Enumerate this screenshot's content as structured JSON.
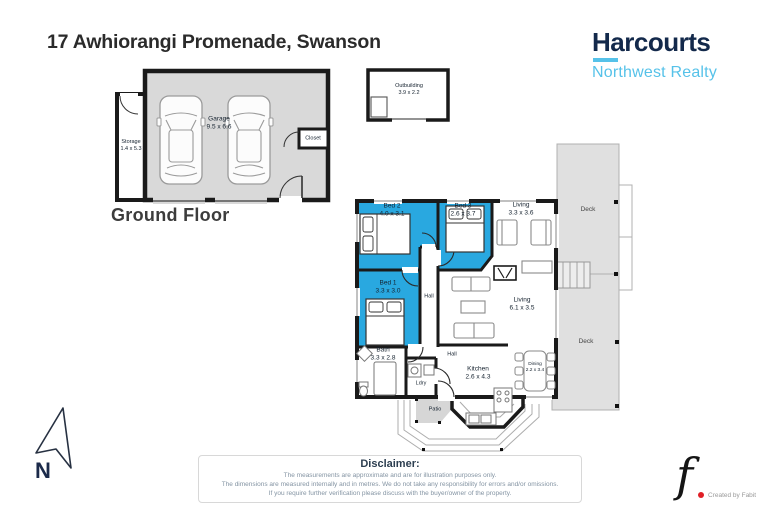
{
  "header": {
    "title": "17 Awhiorangi Promenade, Swanson",
    "brand": {
      "name": "Harcourts",
      "subtitle": "Northwest Realty"
    }
  },
  "ground_floor": {
    "caption": "Ground Floor",
    "rooms": [
      {
        "name": "Garage",
        "dims": "9.5 x 6.6"
      },
      {
        "name": "Storage",
        "dims": "1.4 x 5.3"
      },
      {
        "name": "Closet",
        "dims": ""
      }
    ]
  },
  "outbuilding": {
    "name": "Outbuilding",
    "dims": "3.9 x 2.2"
  },
  "main_floor": {
    "rooms": [
      {
        "name": "Bed 2",
        "dims": "4.0 x 3.1"
      },
      {
        "name": "Bed 3",
        "dims": "2.6 x 3.7"
      },
      {
        "name": "Living",
        "dims": "3.3 x 3.6"
      },
      {
        "name": "Bed 1",
        "dims": "3.3 x 3.0"
      },
      {
        "name": "Hall",
        "dims": ""
      },
      {
        "name": "Living",
        "dims": "6.1 x 3.5"
      },
      {
        "name": "Bath",
        "dims": "3.3 x 2.8"
      },
      {
        "name": "Hall",
        "dims": ""
      },
      {
        "name": "Ldry",
        "dims": ""
      },
      {
        "name": "Kitchen",
        "dims": "2.6 x 4.3"
      },
      {
        "name": "Dining",
        "dims": "2.2 x 3.4"
      },
      {
        "name": "Deck",
        "dims": ""
      },
      {
        "name": "Deck",
        "dims": ""
      },
      {
        "name": "Patio",
        "dims": ""
      }
    ]
  },
  "compass": {
    "label": "N"
  },
  "disclaimer": {
    "title": "Disclaimer:",
    "lines": [
      "The measurements are approximate and are for illustration purposes only.",
      "The dimensions are measured internally and in metres. We do not take any responsibility for errors and/or omissions.",
      "If you require further verification please discuss with the buyer/owner of the property."
    ]
  },
  "credit": {
    "monogram": "f",
    "text": "Created by Fabit"
  },
  "colors": {
    "bedroom_blue": "#29a8e0",
    "garage_gray": "#d9d9d9",
    "deck_gray": "#e0e0e0",
    "patio_gray": "#d6d6d6",
    "wall_black": "#1a1a1a",
    "brand_navy": "#13294b",
    "brand_light_blue": "#56c2e9"
  }
}
